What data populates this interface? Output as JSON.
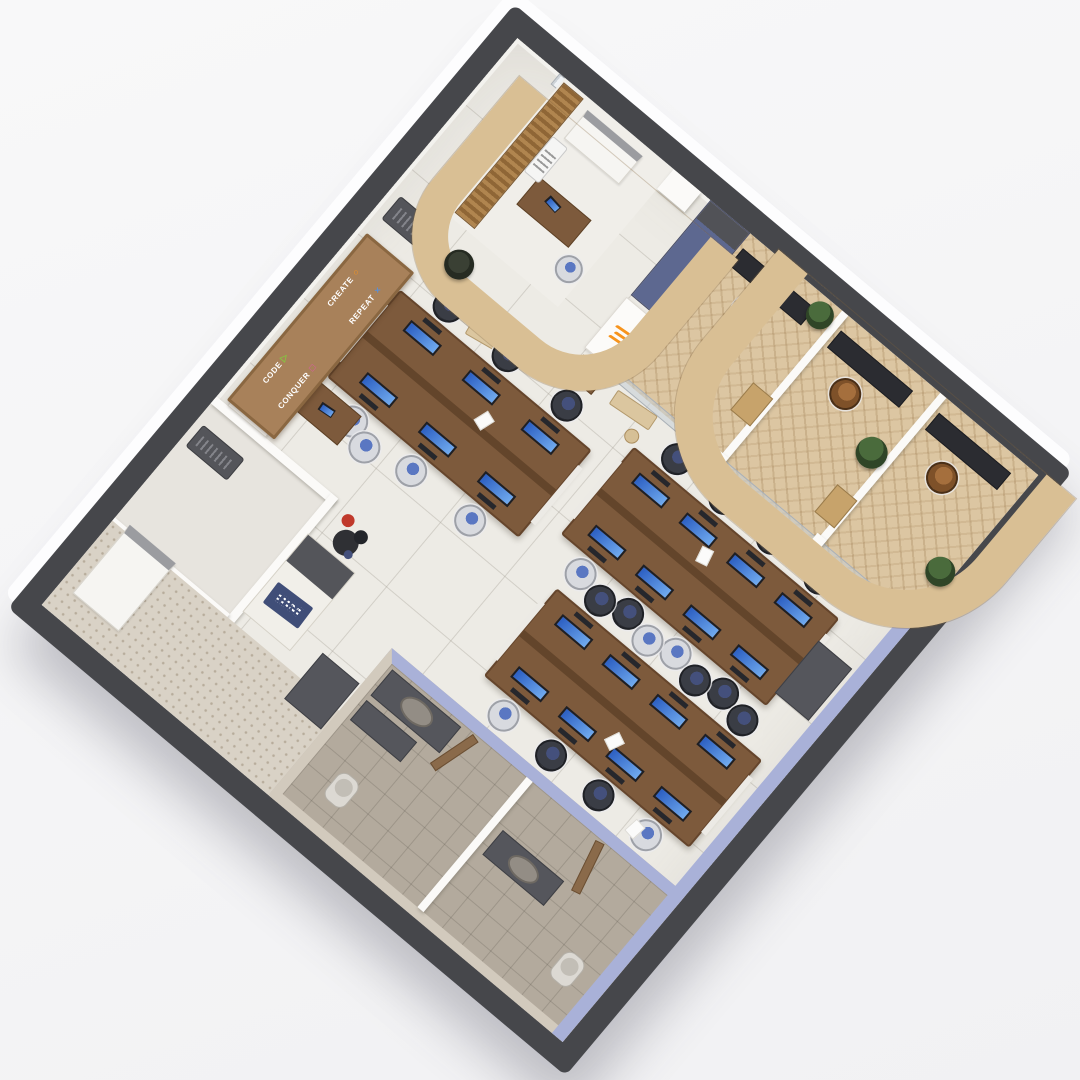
{
  "scene": {
    "description": "3D isometric render of a software office floor plan",
    "background_color": "#f5f5f6",
    "exterior_wall_color": "#46474b",
    "floor_tile_color": "#edebe5",
    "accent_stripe_color": "#a9b1d8",
    "arch_wood_color": "#d9bf94",
    "desk_wood_color": "#7d5a3c",
    "blue_pillar_color": "#5d6890",
    "brand_mark_color": "#f7941d",
    "rotation_deg": 40
  },
  "motto_board": {
    "board_color": "#a8815a",
    "items": [
      {
        "label": "CODE",
        "icon": "triangle-icon",
        "char": "△",
        "color": "#86c440"
      },
      {
        "label": "CONQUER",
        "icon": "square-icon",
        "char": "□",
        "color": "#e255ae"
      },
      {
        "label": "CREATE",
        "icon": "circle-icon",
        "char": "○",
        "color": "#f7941d"
      },
      {
        "label": "REPEAT",
        "icon": "cross-icon",
        "char": "×",
        "color": "#5a8fd6"
      }
    ]
  },
  "reception": {
    "logo_text": "IBM",
    "logo_bg": "#404e78"
  },
  "inventory": {
    "desk_clusters": 3,
    "workstations_per_cluster": [
      6,
      8,
      8
    ],
    "private_cabins": 3,
    "restroom_stalls": 2,
    "wood_arches": 2,
    "plants": 5,
    "ac_units": 3,
    "benches": 4
  }
}
